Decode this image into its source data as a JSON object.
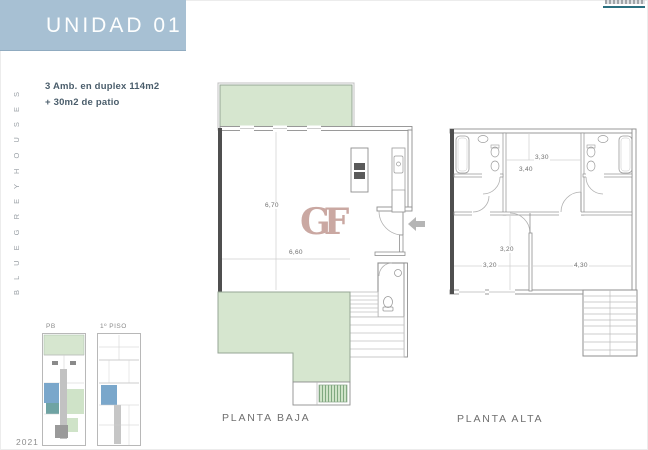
{
  "header": {
    "unit_title": "UNIDAD 01",
    "banner_color": "#a7c0d3",
    "summary_line1": "3 Amb. en duplex 114m2",
    "summary_line2": "+ 30m2 de patio",
    "top_right_underline_color": "#2a6f7f"
  },
  "sidebar": {
    "vertical_label": "B L U E   G R E Y   H O U S E S",
    "year": "2021"
  },
  "thumbnails": {
    "ground_floor_label": "PB",
    "first_floor_label": "1º PISO"
  },
  "plans": {
    "planta_baja": {
      "caption": "PLANTA BAJA",
      "dim_vertical": "6,70",
      "dim_horizontal": "6,60"
    },
    "planta_alta": {
      "caption": "PLANTA ALTA",
      "dim_bed_width": "3,30",
      "dim_bed_height": "3,40",
      "dim_hall_vertical": "3,20",
      "dim_hall_horizontal": "3,20",
      "dim_right_room": "4,30"
    }
  },
  "watermark": {
    "text": "GF",
    "color": "#c6a19b"
  },
  "palette": {
    "patio_green": "#d6e6cf",
    "patio_hatch_green": "#7fa87f",
    "wall_gray": "#8f8f8f",
    "wall_dark": "#4f4f4f",
    "thumb_blue": "#7aa7cb",
    "thumb_teal": "#6fa3a3",
    "thumb_gray": "#b5b5b5",
    "arrow_gray": "#b5b5b5"
  }
}
